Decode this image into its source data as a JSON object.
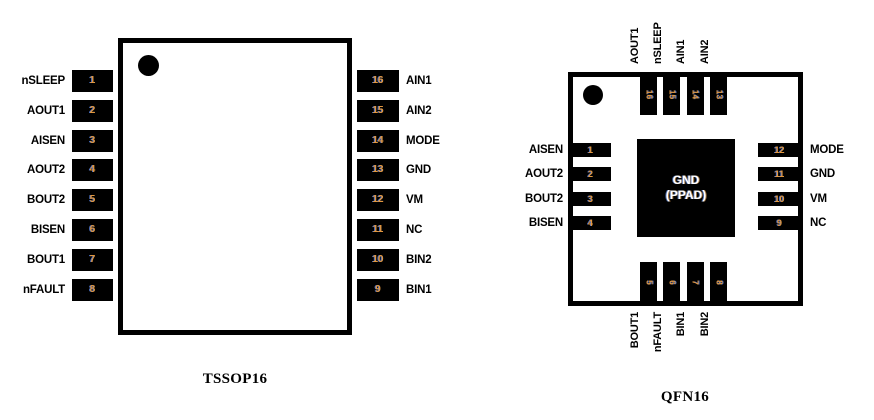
{
  "tssop": {
    "title": "TSSOP16",
    "left_pins": [
      {
        "num": "1",
        "label": "nSLEEP"
      },
      {
        "num": "2",
        "label": "AOUT1"
      },
      {
        "num": "3",
        "label": "AISEN"
      },
      {
        "num": "4",
        "label": "AOUT2"
      },
      {
        "num": "5",
        "label": "BOUT2"
      },
      {
        "num": "6",
        "label": "BISEN"
      },
      {
        "num": "7",
        "label": "BOUT1"
      },
      {
        "num": "8",
        "label": "nFAULT"
      }
    ],
    "right_pins": [
      {
        "num": "16",
        "label": "AIN1"
      },
      {
        "num": "15",
        "label": "AIN2"
      },
      {
        "num": "14",
        "label": "MODE"
      },
      {
        "num": "13",
        "label": "GND"
      },
      {
        "num": "12",
        "label": "VM"
      },
      {
        "num": "11",
        "label": "NC"
      },
      {
        "num": "10",
        "label": "BIN2"
      },
      {
        "num": "9",
        "label": "BIN1"
      }
    ]
  },
  "qfn": {
    "title": "QFN16",
    "top_pins": [
      {
        "num": "16",
        "label": "AOUT1"
      },
      {
        "num": "15",
        "label": "nSLEEP"
      },
      {
        "num": "14",
        "label": "AIN1"
      },
      {
        "num": "13",
        "label": "AIN2"
      }
    ],
    "left_pins": [
      {
        "num": "1",
        "label": "AISEN"
      },
      {
        "num": "2",
        "label": "AOUT2"
      },
      {
        "num": "3",
        "label": "BOUT2"
      },
      {
        "num": "4",
        "label": "BISEN"
      }
    ],
    "right_pins": [
      {
        "num": "12",
        "label": "MODE"
      },
      {
        "num": "11",
        "label": "GND"
      },
      {
        "num": "10",
        "label": "VM"
      },
      {
        "num": "9",
        "label": "NC"
      }
    ],
    "bottom_pins": [
      {
        "num": "5",
        "label": "BOUT1"
      },
      {
        "num": "6",
        "label": "nFAULT"
      },
      {
        "num": "7",
        "label": "BIN1"
      },
      {
        "num": "8",
        "label": "BIN2"
      }
    ],
    "pad_label": {
      "line1": "GND",
      "line2": "(PPAD)"
    }
  },
  "colors": {
    "ink": "#000000",
    "pin_number": "#e2973f",
    "pad_text": "#ffffff"
  }
}
